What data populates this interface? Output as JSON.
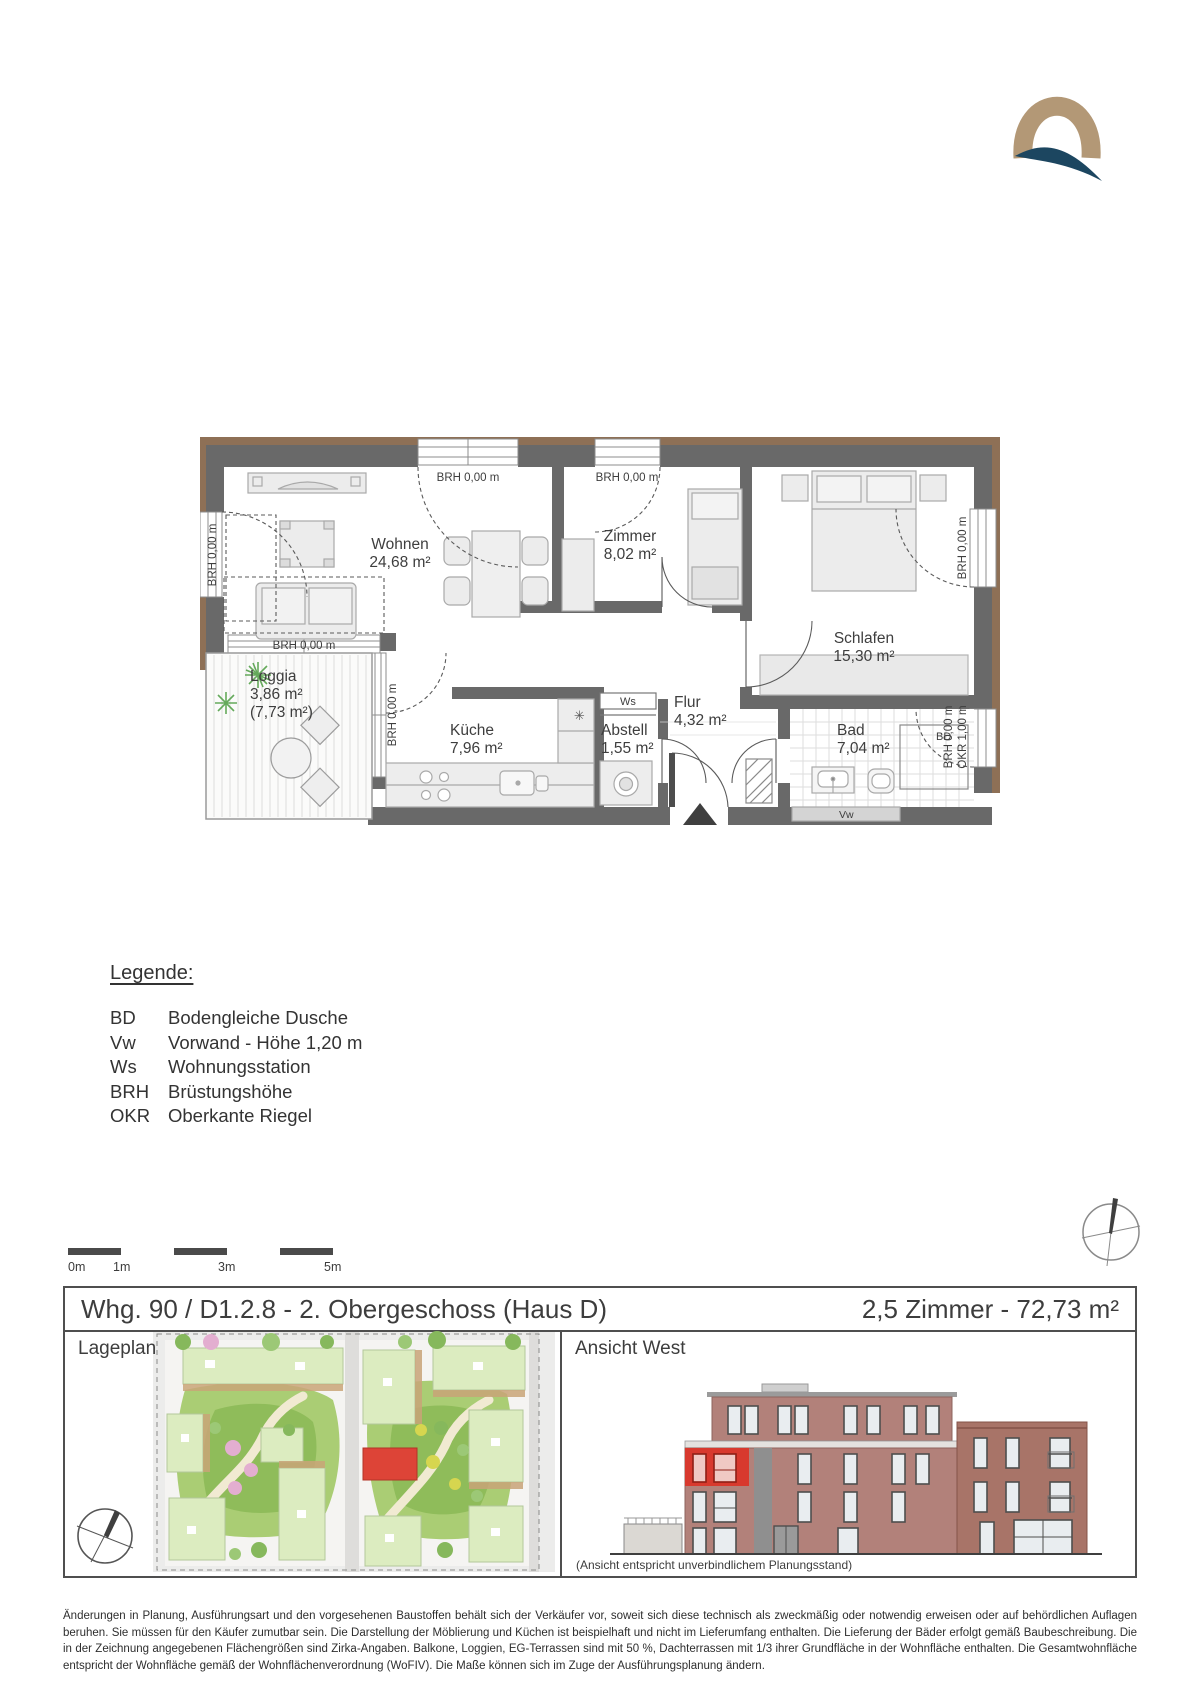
{
  "logo": {
    "name": "q-logo"
  },
  "plan": {
    "rooms": {
      "wohnen": {
        "name": "Wohnen",
        "area": "24,68 m²"
      },
      "zimmer": {
        "name": "Zimmer",
        "area": "8,02 m²"
      },
      "schlafen": {
        "name": "Schlafen",
        "area": "15,30 m²"
      },
      "loggia": {
        "name": "Loggia",
        "area": "3,86 m²",
        "area_half": "(7,73 m²)"
      },
      "kueche": {
        "name": "Küche",
        "area": "7,96 m²"
      },
      "abstell": {
        "name": "Abstell",
        "area": "1,55 m²"
      },
      "flur": {
        "name": "Flur",
        "area": "4,32 m²"
      },
      "bad": {
        "name": "Bad",
        "area": "7,04 m²"
      }
    },
    "labels": {
      "brh": "BRH 0,00 m",
      "okr": "OKR 1,00 m",
      "ws": "Ws",
      "bd": "BD",
      "vw": "Vw"
    }
  },
  "legend": {
    "title": "Legende:",
    "items": [
      {
        "abbr": "BD",
        "label": "Bodengleiche Dusche"
      },
      {
        "abbr": "Vw",
        "label": "Vorwand - Höhe 1,20 m"
      },
      {
        "abbr": "Ws",
        "label": "Wohnungsstation"
      },
      {
        "abbr": "BRH",
        "label": "Brüstungshöhe"
      },
      {
        "abbr": "OKR",
        "label": "Oberkante Riegel"
      }
    ]
  },
  "scalebar": {
    "ticks": [
      "0m",
      "1m",
      "3m",
      "5m"
    ]
  },
  "titlebar": {
    "left": "Whg. 90 / D1.2.8 - 2. Obergeschoss (Haus D)",
    "right": "2,5 Zimmer - 72,73 m²"
  },
  "siteplan": {
    "title": "Lageplan"
  },
  "elevation": {
    "title": "Ansicht West",
    "caption": "(Ansicht entspricht unverbindlichem Planungsstand)"
  },
  "footer": {
    "text": "Änderungen in Planung, Ausführungsart und den vorgesehenen Baustoffen behält sich der Verkäufer vor, soweit sich diese technisch als zweckmäßig oder notwendig erweisen oder auf behördlichen Auflagen beruhen. Sie müssen für den Käufer zumutbar sein. Die Darstellung der Möblierung und Küchen ist beispielhaft und nicht im Lieferumfang enthalten. Die Lieferung der Bäder erfolgt gemäß Baubeschreibung. Die in der Zeichnung angegebenen Flächengrößen sind Zirka-Angaben. Balkone, Loggien, EG-Terrassen sind mit 50 %, Dachterrassen mit 1/3 ihrer Grundfläche in der Wohnfläche enthalten. Die Gesamtwohnfläche entspricht der Wohnfläche gemäß der Wohnflächenverordnung (WoFIV). Die Maße können sich im Zuge der Ausführungsplanung ändern."
  },
  "colors": {
    "wall": "#696969",
    "facade": "#8e7056",
    "accent_red": "#d8392e",
    "logo_gold": "#b39876",
    "logo_navy": "#1c4660"
  }
}
